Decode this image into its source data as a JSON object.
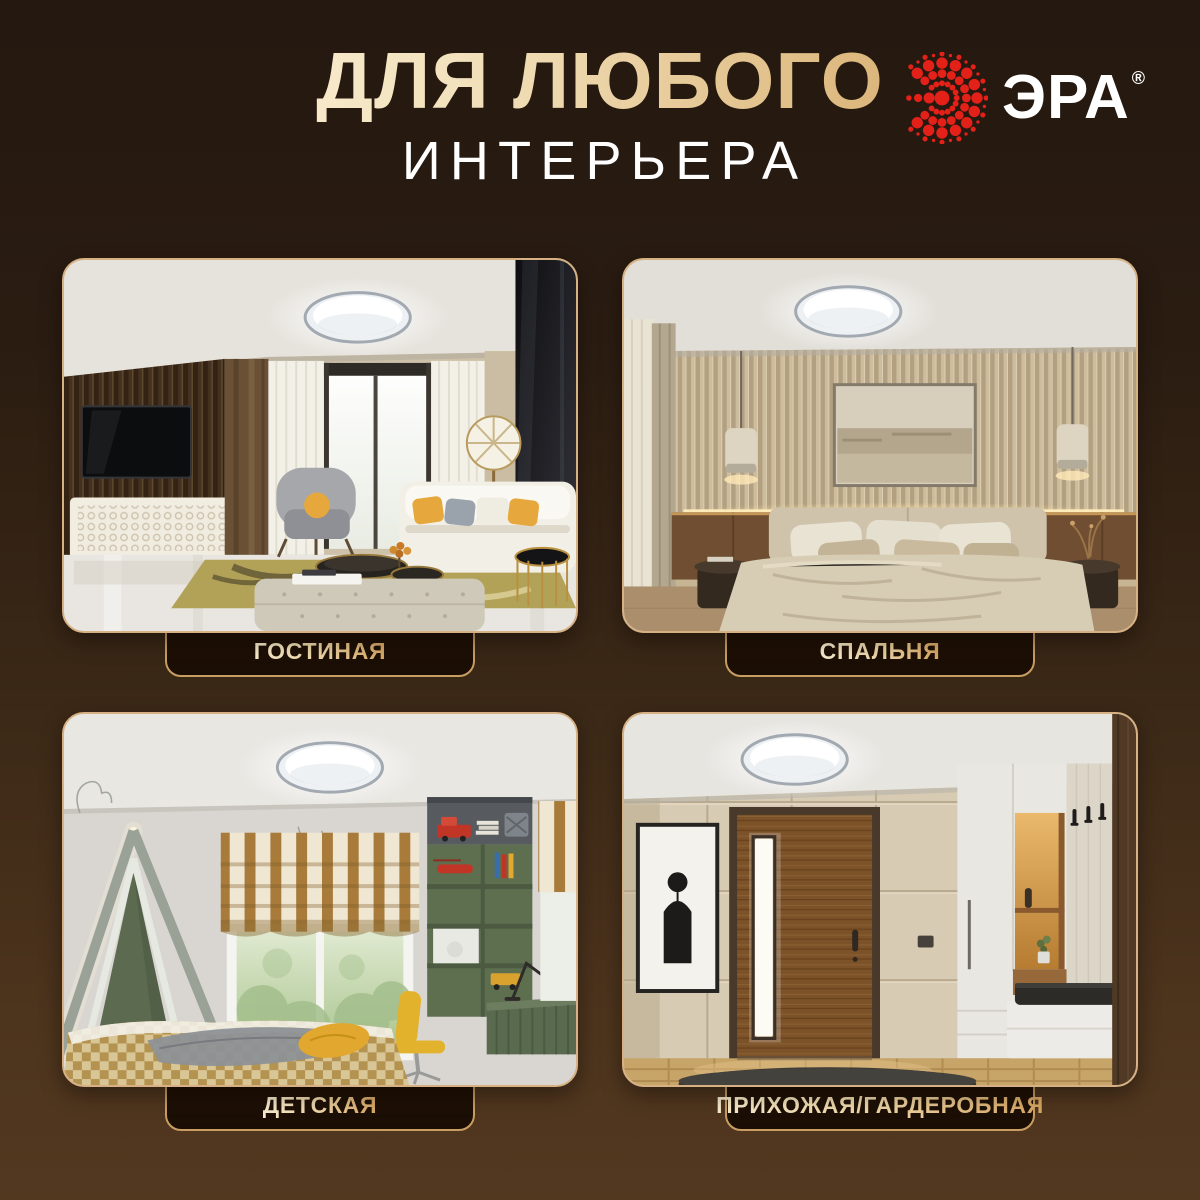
{
  "header": {
    "title_line1": "ДЛЯ ЛЮБОГО",
    "title_line2": "ИНТЕРЬЕРА"
  },
  "brand": {
    "name": "ЭРА",
    "registered_mark": "®",
    "logo_icon": "era-dotted-sunburst-icon",
    "logo_red": "#e32119",
    "text_color": "#ffffff"
  },
  "cards": [
    {
      "id": "living-room",
      "label": "ГОСТИНАЯ",
      "photo": "living-room-with-round-led-ceiling-light"
    },
    {
      "id": "bedroom",
      "label": "СПАЛЬНЯ",
      "photo": "bedroom-with-round-led-ceiling-light"
    },
    {
      "id": "kids-room",
      "label": "ДЕТСКАЯ",
      "photo": "kids-room-with-round-led-ceiling-light"
    },
    {
      "id": "hallway",
      "label": "ПРИХОЖАЯ/ГАРДЕРОБНАЯ",
      "photo": "hallway-wardrobe-with-round-led-ceiling-light"
    }
  ],
  "colors": {
    "background_top": "#241810",
    "background_bottom": "#533820",
    "card_border_gold": "#d7b184",
    "badge_background": "#1c1007",
    "badge_border": "#c99e62",
    "title_gradient_start": "#fdf7e5",
    "title_gradient_end": "#d0a263",
    "subtitle_white": "#ffffff",
    "label_gradient_start": "#f8eccd",
    "label_gradient_end": "#d8a763"
  }
}
